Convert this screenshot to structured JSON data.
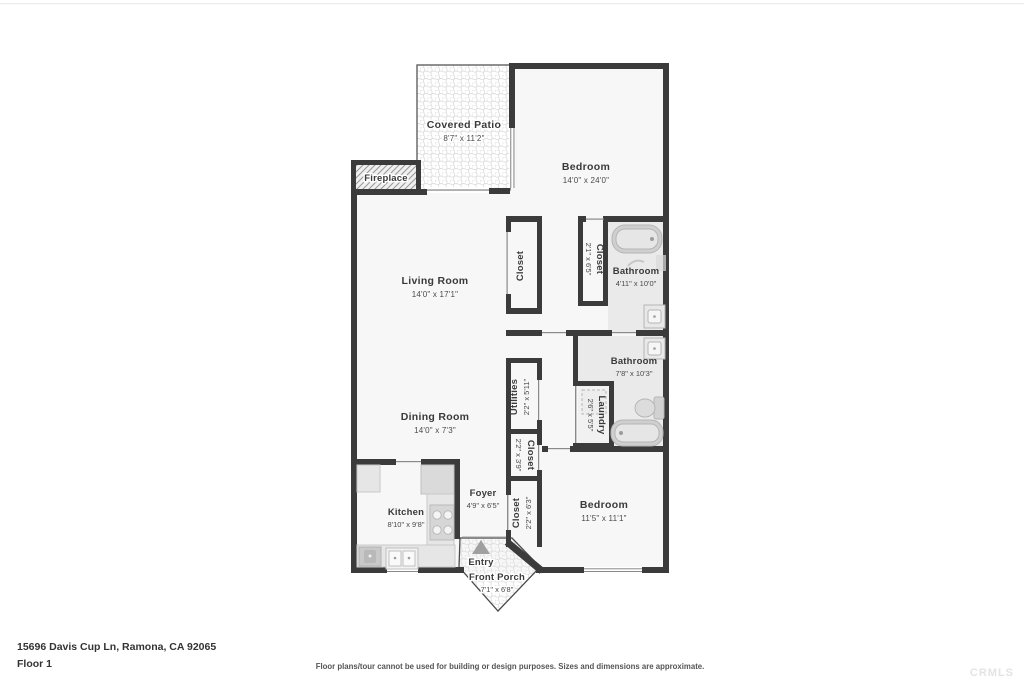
{
  "meta": {
    "address": "15696 Davis Cup Ln, Ramona, CA 92065",
    "floor_label": "Floor 1",
    "disclaimer": "Floor plans/tour cannot be used for building or design purposes. Sizes and dimensions are approximate.",
    "watermark": "CRMLS"
  },
  "rooms": {
    "covered_patio": {
      "name": "Covered Patio",
      "dims": "8'7\" x 11'2\""
    },
    "bedroom_1": {
      "name": "Bedroom",
      "dims": "14'0\" x 24'0\""
    },
    "fireplace": {
      "name": "Fireplace"
    },
    "living_room": {
      "name": "Living Room",
      "dims": "14'0\" x 17'1\""
    },
    "living_closet": {
      "name": "Closet"
    },
    "bedroom1_closet": {
      "name": "Closet",
      "dims": "2'1\" x 6'5\""
    },
    "bathroom_1": {
      "name": "Bathroom",
      "dims": "4'11\" x 10'0\""
    },
    "bathroom_2": {
      "name": "Bathroom",
      "dims": "7'8\" x 10'3\""
    },
    "laundry": {
      "name": "Laundry",
      "dims": "2'6\" x 5'5\""
    },
    "utilities": {
      "name": "Utilities",
      "dims": "2'2\" x 5'11\""
    },
    "hall_closet": {
      "name": "Closet",
      "dims": "2'2\" x 3'9\""
    },
    "dining_room": {
      "name": "Dining Room",
      "dims": "14'0\" x 7'3\""
    },
    "kitchen": {
      "name": "Kitchen",
      "dims": "8'10\" x 9'8\""
    },
    "foyer": {
      "name": "Foyer",
      "dims": "4'9\" x 6'5\""
    },
    "foyer_closet": {
      "name": "Closet",
      "dims": "2'2\" x 6'3\""
    },
    "bedroom_2": {
      "name": "Bedroom",
      "dims": "11'5\" x 11'1\""
    },
    "entry": {
      "name": "Entry"
    },
    "front_porch": {
      "name": "Front Porch",
      "dims": "7'1\" x 6'8\""
    }
  },
  "icons": {
    "entry_arrow": "triangle-up",
    "fireplace_hatch": "diagonal-hatch",
    "patio_tile": "honeycomb-tile"
  }
}
